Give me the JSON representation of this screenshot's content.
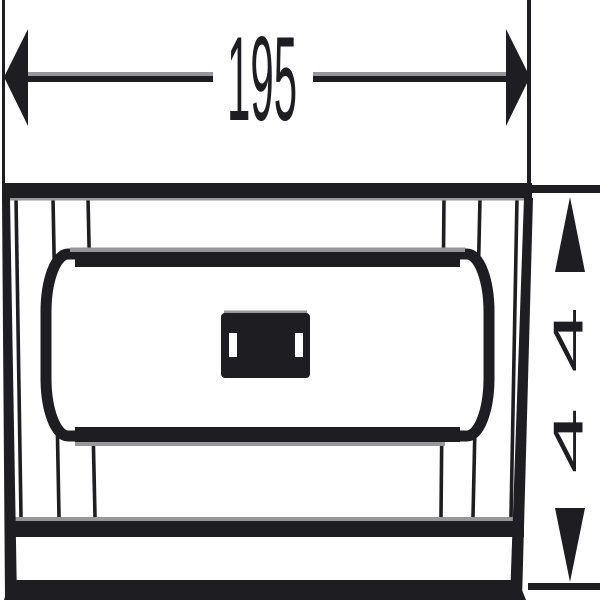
{
  "drawing": {
    "description": "technical dimension line drawing of a rectangular basket/soap dish seen from the front",
    "dimensions": {
      "width": {
        "label": "195"
      },
      "height": {
        "label": "44"
      }
    }
  },
  "colors": {
    "line": "#1e1e22",
    "gray": "#97979b",
    "background": "#ffffff"
  }
}
